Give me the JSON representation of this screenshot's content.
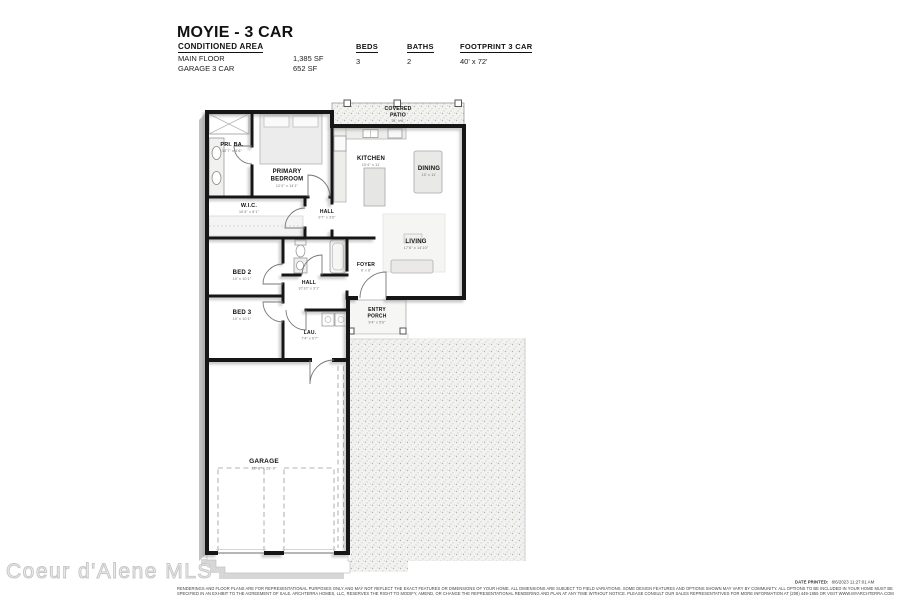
{
  "header": {
    "title": "MOYIE - 3 CAR",
    "conditioned_area_label": "CONDITIONED AREA",
    "area_rows": [
      {
        "label": "MAIN FLOOR",
        "value": "1,385 SF"
      },
      {
        "label": "GARAGE 3 CAR",
        "value": "652 SF"
      }
    ],
    "stats": [
      {
        "label": "BEDS",
        "value": "3"
      },
      {
        "label": "BATHS",
        "value": "2"
      },
      {
        "label": "FOOTPRINT 3 CAR",
        "value": "40' x 72'"
      }
    ]
  },
  "floorplan": {
    "rooms": {
      "patio": {
        "l1": "COVERED",
        "l2": "PATIO",
        "dims": "21' x 6'"
      },
      "priba": {
        "l1": "PRI. BA.",
        "dims": "10'7\" x 5'6\""
      },
      "primary": {
        "l1": "PRIMARY",
        "l2": "BEDROOM",
        "dims": "12'4\" x 14'1\""
      },
      "wic": {
        "l1": "W.I.C.",
        "dims": "10'4\" x 6'1\""
      },
      "kitchen": {
        "l1": "KITCHEN",
        "dims": "10'4\" x 11'"
      },
      "dining": {
        "l1": "DINING",
        "dims": "10' x 11'"
      },
      "hall_u": {
        "l1": "HALL",
        "dims": "9'7\" x 3'6\""
      },
      "living": {
        "l1": "LIVING",
        "dims": "17'8\" x 14'10\""
      },
      "bed2": {
        "l1": "BED 2",
        "dims": "10' x 10'1\""
      },
      "foyer": {
        "l1": "FOYER",
        "dims": "6' x 6'"
      },
      "hall_l": {
        "l1": "HALL",
        "dims": "10'10\" x 3'1\""
      },
      "bed3": {
        "l1": "BED 3",
        "dims": "10' x 10'1\""
      },
      "lau": {
        "l1": "LAU.",
        "dims": "7'4\" x 6'7\""
      },
      "porch": {
        "l1": "ENTRY",
        "l2": "PORCH",
        "dims": "9'4\" x 5'6\""
      },
      "garage": {
        "l1": "GARAGE",
        "dims": "22'-8\" x 28'-9\""
      }
    }
  },
  "watermark": "Coeur d'Alene MLS",
  "footer": {
    "disclaimer_line1": "RENDERINGS AND FLOOR PLANS ARE FOR REPRESENTATIONAL PURPOSES ONLY AND MAY NOT REFLECT THE EXACT FEATURES OR DIMENSIONS OF YOUR HOME. ALL DIMENSIONS ARE SUBJECT TO FIELD VARIATIONS. SOME DESIGN FEATURES AND OPTIONS SHOWN MAY VARY BY COMMUNITY. ALL OPTIONS TO BE INCLUDED IN YOUR HOME MUST BE",
    "disclaimer_line2": "SPECIFIED IN AN EXHIBIT TO THE AGREEMENT OF SALE. ARCHTERRA HOMES, LLC, RESERVES THE RIGHT TO MODIFY, AMEND, OR CHANGE THE REPRESENTATIONAL RENDERING AND PLAN AT ANY TIME WITHOUT NOTICE. PLEASE CONSULT OUR SALES REPRESENTATIVES FOR MORE INFORMATION AT (208) 449-1955 OR VISIT WWW.MYARCHTERRA.COM",
    "date_printed_label": "DATE PRINTED:",
    "date_printed_value": "8/6/2023 11:27:01 AM"
  },
  "colors": {
    "wall": "#141414",
    "shadow": "#b8b8b8",
    "stipple_bg": "#f2f2f0",
    "dim_text": "#6e6e6e"
  }
}
